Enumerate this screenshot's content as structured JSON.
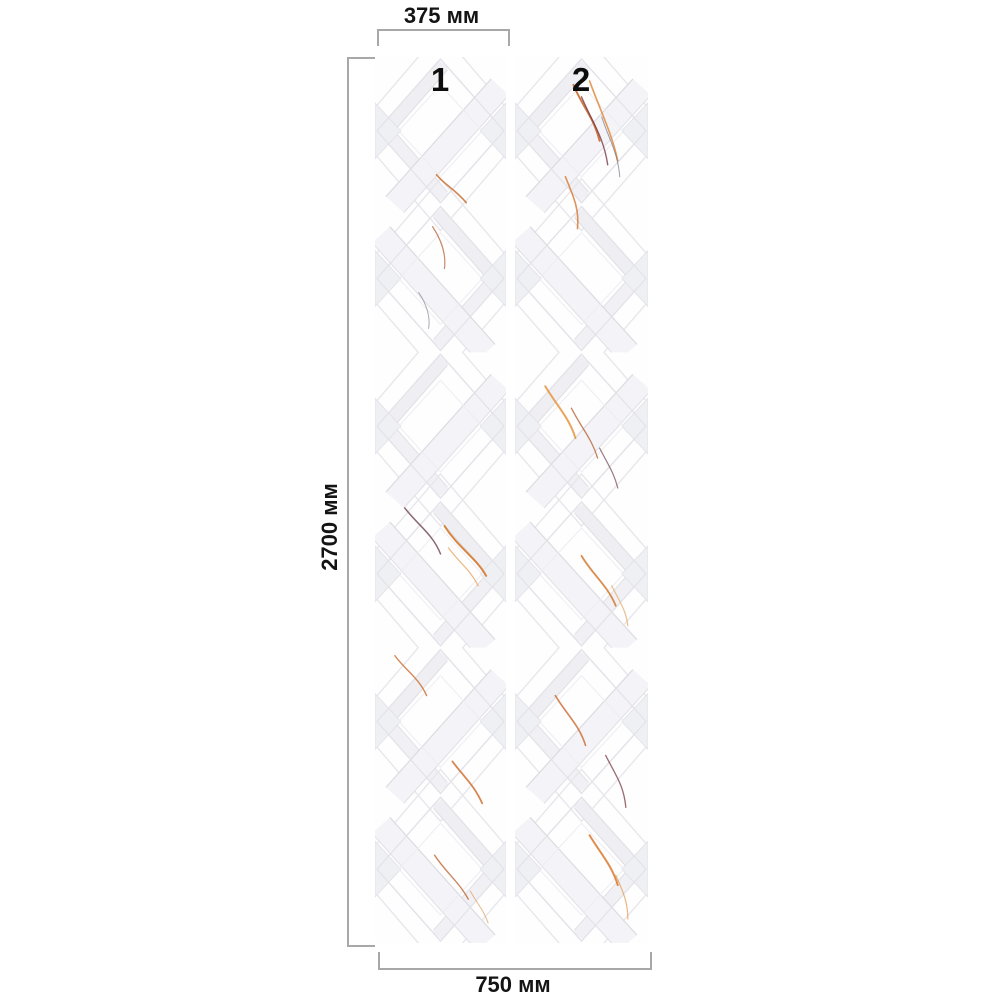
{
  "diagram": {
    "title": "wall-panel-dimension-diagram",
    "dimensions": {
      "top": {
        "label": "375 мм"
      },
      "left": {
        "label": "2700 мм"
      },
      "bottom": {
        "label": "750 мм"
      }
    },
    "panels": [
      {
        "number": "1"
      },
      {
        "number": "2"
      }
    ],
    "colors": {
      "background": "#ffffff",
      "dimension_line": "#a8a8a8",
      "label_text": "#141414",
      "panel_background": "#fefeff",
      "lattice_line": "#e2e2e8",
      "marble_band": "#f1f1f5",
      "vein_orange": "#d4792f",
      "vein_dark_red": "#7a3b42",
      "vein_grey": "#5d5f6e"
    }
  }
}
